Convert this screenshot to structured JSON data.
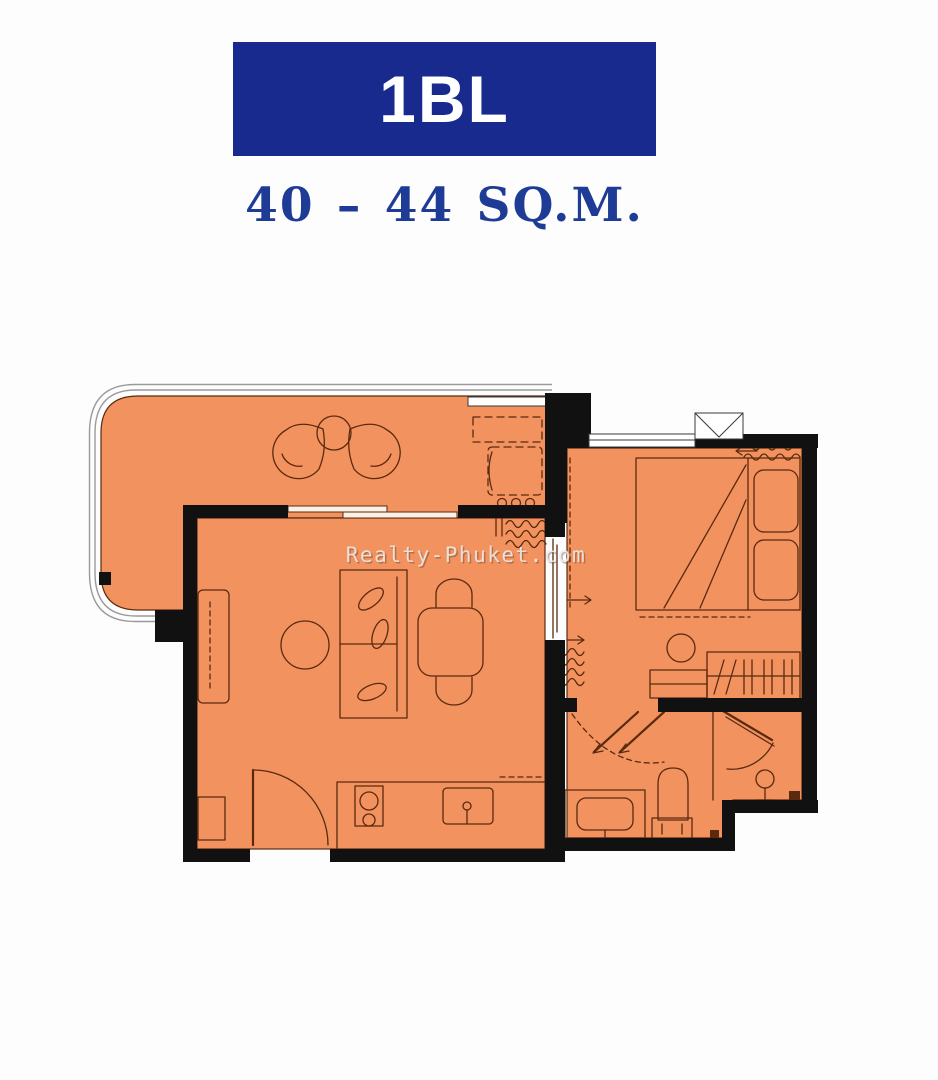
{
  "header": {
    "unit_code": "1BL",
    "area_range": "40 – 44 SQ.M."
  },
  "floorplan": {
    "watermark": "Realty-Phuket.com"
  },
  "colors": {
    "navy": "#182a8e",
    "navy2": "#1e3c96",
    "orange": "#f2925e",
    "wall": "#111111",
    "line": "#5a2a10",
    "bg": "#fdfdfd",
    "white": "#ffffff",
    "rail": "#9a9a9a",
    "wm": "#ececec"
  }
}
